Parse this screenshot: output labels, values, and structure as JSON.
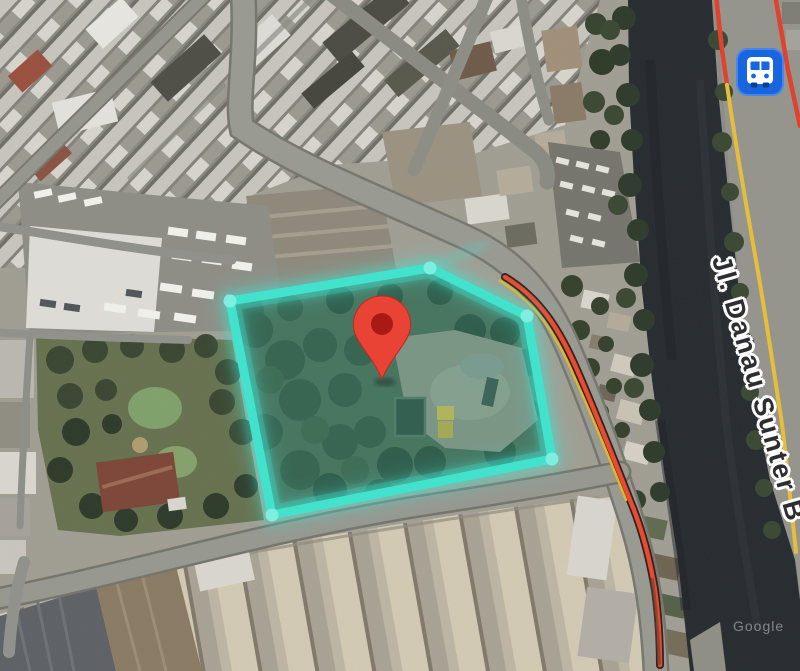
{
  "map_view": {
    "kind": "satellite-map",
    "labels": {
      "road": "Jl. Danau Sunter B",
      "watermark": "Google"
    },
    "markers": {
      "location_pin": {
        "icon": "map-pin-icon",
        "color": "#E94335",
        "inner_dot_color": "#A91B12",
        "tip_x": 382,
        "tip_y": 379
      },
      "bus_station": {
        "icon": "bus-station-icon",
        "color": "#1766E0",
        "glyph_color": "#FFFFFF",
        "x": 760,
        "y": 72
      }
    },
    "overlays": {
      "property_boundary": {
        "stroke_color": "#3FE3CD",
        "glow_color": "#40E6D4",
        "fill_opacity": 0.22,
        "vertices": [
          [
            230,
            301
          ],
          [
            430,
            268
          ],
          [
            527,
            316
          ],
          [
            552,
            459
          ],
          [
            272,
            515
          ]
        ]
      },
      "transit_line_color": "#E8492F",
      "road_centerline_color": "#E6BE37",
      "river_color": "#262B2F"
    }
  }
}
